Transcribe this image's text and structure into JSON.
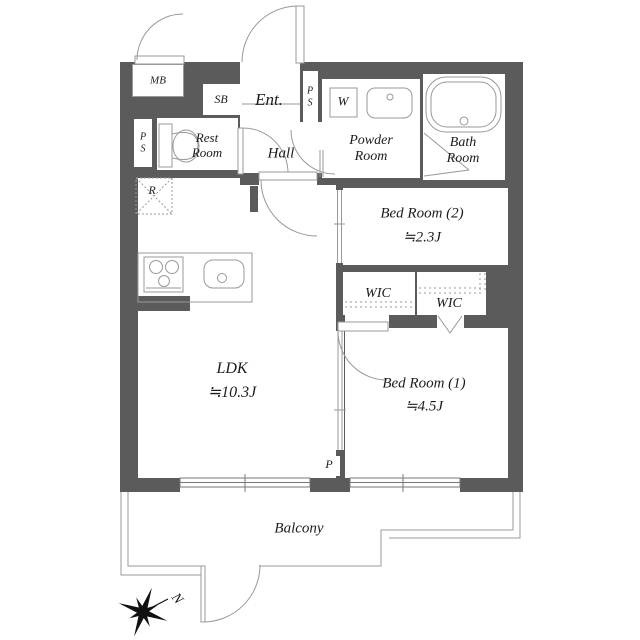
{
  "labels": {
    "mb": "MB",
    "sb": "SB",
    "ent": "Ent.",
    "ps_top_l1": "P",
    "ps_top_l2": "S",
    "ps_left_l1": "P",
    "ps_left_l2": "S",
    "w": "W",
    "powder_l1": "Powder",
    "powder_l2": "Room",
    "bath_l1": "Bath",
    "bath_l2": "Room",
    "rest_l1": "Rest",
    "rest_l2": "Room",
    "hall": "Hall",
    "r": "R",
    "bedroom2_name": "Bed Room (2)",
    "bedroom2_area": "≒2.3J",
    "wic1": "WIC",
    "wic2": "WIC",
    "ldk_name": "LDK",
    "ldk_area": "≒10.3J",
    "bedroom1_name": "Bed Room (1)",
    "bedroom1_area": "≒4.5J",
    "p": "P",
    "balcony": "Balcony",
    "compass_north": "N"
  },
  "colors": {
    "wall": "#5b5b5b",
    "line": "#999999",
    "text": "#1c1c1c",
    "background": "#ffffff"
  }
}
